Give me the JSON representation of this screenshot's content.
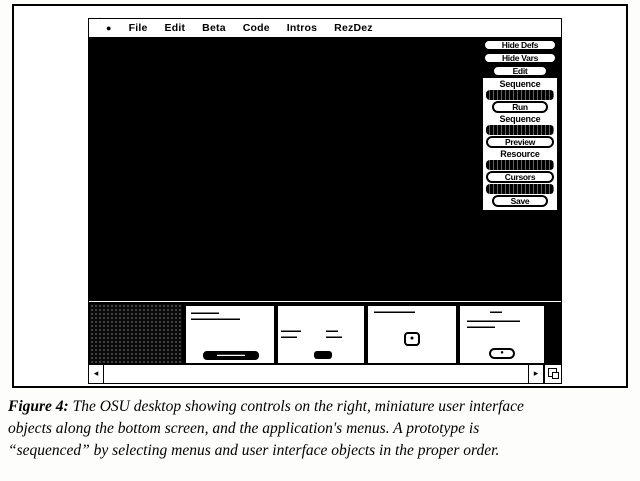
{
  "menubar": {
    "apple_icon": "●",
    "items": [
      "File",
      "Edit",
      "Beta",
      "Code",
      "Intros",
      "RezDez"
    ]
  },
  "control_panel": {
    "top_buttons": [
      {
        "label": "Hide Defs"
      },
      {
        "label": "Hide Vars"
      },
      {
        "label": "Edit"
      }
    ],
    "rows": [
      {
        "type": "label",
        "label": "Sequence"
      },
      {
        "type": "bar",
        "label": ""
      },
      {
        "type": "button",
        "label": "Run"
      },
      {
        "type": "label",
        "label": "Sequence"
      },
      {
        "type": "bar",
        "label": ""
      },
      {
        "type": "button",
        "label": "Preview"
      },
      {
        "type": "label",
        "label": "Resource"
      },
      {
        "type": "bar",
        "label": ""
      },
      {
        "type": "button",
        "label": "Cursors"
      },
      {
        "type": "bar",
        "label": ""
      },
      {
        "type": "button",
        "label": "Save"
      }
    ]
  },
  "mini_windows": {
    "win1": {
      "line1": "▬▬▬▬ ▬▬▬",
      "line2": "▬▬▬▬▬▬ ▬▬▬▬ ▬▬",
      "button_label": "▬▬▬▬▬▬▬"
    },
    "win2": {
      "left1": "▬▬▬ ▬▬",
      "left2": "▬▬▬ ▬",
      "right1": "▬▬▬",
      "right2": "▬▬▬▬",
      "button_label": ""
    },
    "win3": {
      "title": "▬▬▬▬▬ ▬▬▬ ▬▬",
      "icon": "●"
    },
    "win4": {
      "title": "▬▬▬",
      "line1": "▬▬▬▬▬▬▬ ▬▬ ▬▬▬▬",
      "line2": "▬▬▬▬ ▬▬▬",
      "button_icon": "●"
    }
  },
  "scrollbar": {
    "left_arrow": "◂",
    "right_arrow": "▸"
  },
  "caption": {
    "prefix": "Figure 4:",
    "line1": " The OSU desktop showing controls on the right, miniature user interface",
    "line2": "objects along the bottom screen, and the application's menus. A prototype is",
    "line3": "“sequenced” by selecting menus and user interface objects in the proper order."
  }
}
